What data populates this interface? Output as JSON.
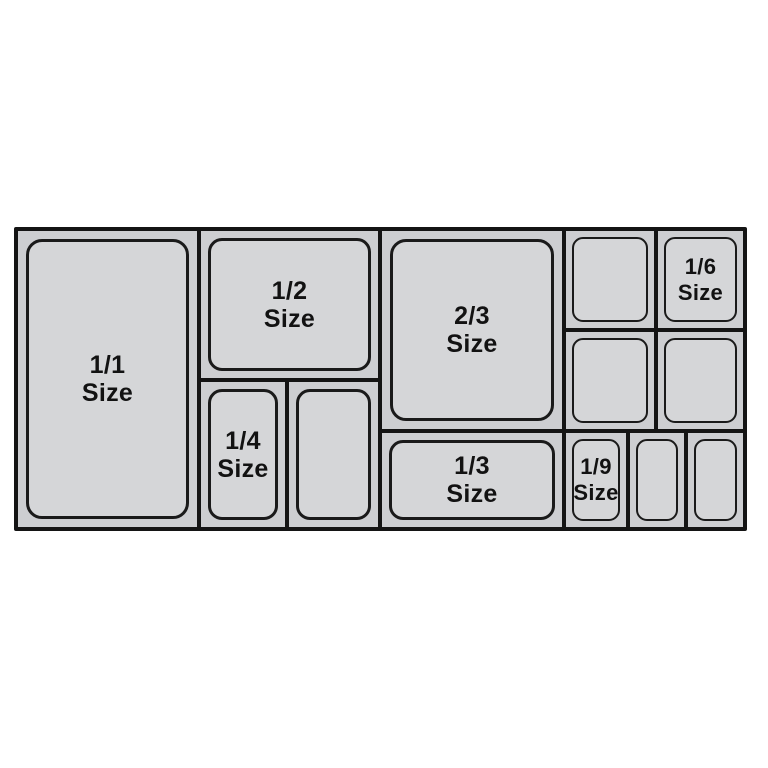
{
  "colors": {
    "page_background": "#ffffff",
    "frame_line": "#141414",
    "cell_fill": "#cdced1",
    "pan_fill": "#d5d6d8",
    "pan_outline": "#1a1a1a",
    "label_text": "#121212"
  },
  "labels": {
    "full": {
      "fraction": "1/1",
      "word": "Size"
    },
    "half": {
      "fraction": "1/2",
      "word": "Size"
    },
    "quarter": {
      "fraction": "1/4",
      "word": "Size"
    },
    "two_thirds": {
      "fraction": "2/3",
      "word": "Size"
    },
    "third": {
      "fraction": "1/3",
      "word": "Size"
    },
    "sixth": {
      "fraction": "1/6",
      "word": "Size"
    },
    "ninth": {
      "fraction": "1/9",
      "word": "Size"
    }
  }
}
